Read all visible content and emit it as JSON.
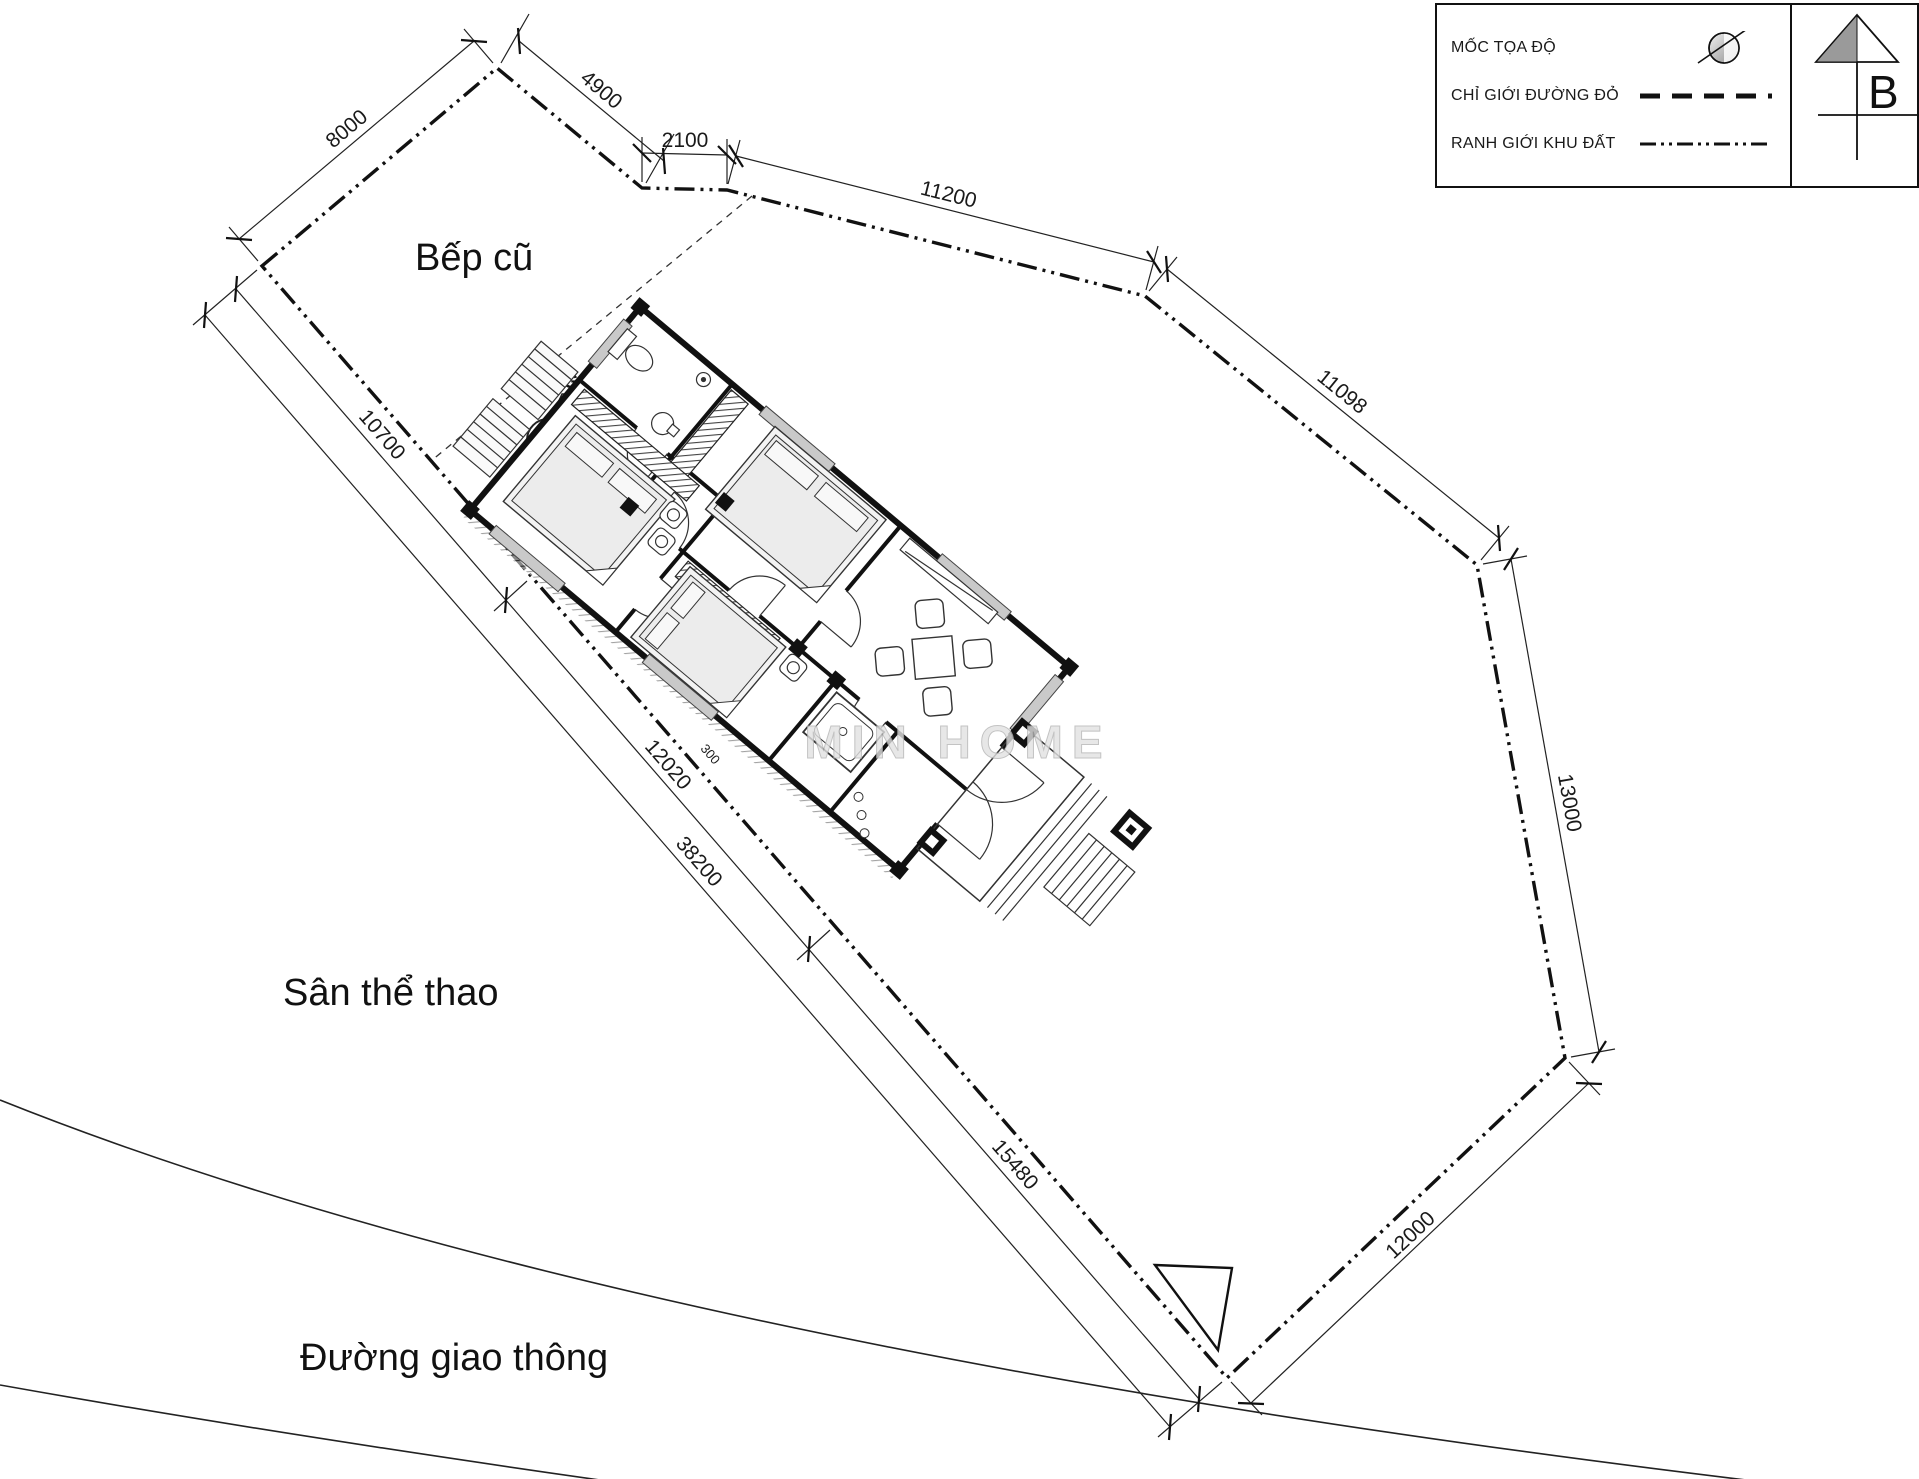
{
  "legend": {
    "items": [
      {
        "label": "MỐC TỌA ĐỘ",
        "symbol": "survey-marker"
      },
      {
        "label": "CHỈ GIỚI ĐƯỜNG ĐỎ",
        "symbol": "red-boundary-dashed-line"
      },
      {
        "label": "RANH GIỚI KHU ĐẤT",
        "symbol": "site-boundary-dashdot-line"
      }
    ]
  },
  "north_arrow": {
    "label": "B"
  },
  "area_labels": {
    "old_kitchen": "Bếp cũ",
    "well": "GIẾNG",
    "sports_yard": "Sân thể thao",
    "road": "Đường giao thông"
  },
  "watermark": "MIN HOME",
  "dimensions": {
    "top_8000": "8000",
    "top_4900": "4900",
    "top_2100": "2100",
    "ne_11200": "11200",
    "ne_11098": "11098",
    "e_13000": "13000",
    "se_12000": "12000",
    "sw_10700": "10700",
    "sw_12020": "12020",
    "sw_15480": "15480",
    "sw_total_38200": "38200",
    "setback_300": "300"
  },
  "colors": {
    "ink": "#1a1a1a",
    "wall_fill": "#e9e9e9",
    "watermark_gray": "#cccccc"
  }
}
